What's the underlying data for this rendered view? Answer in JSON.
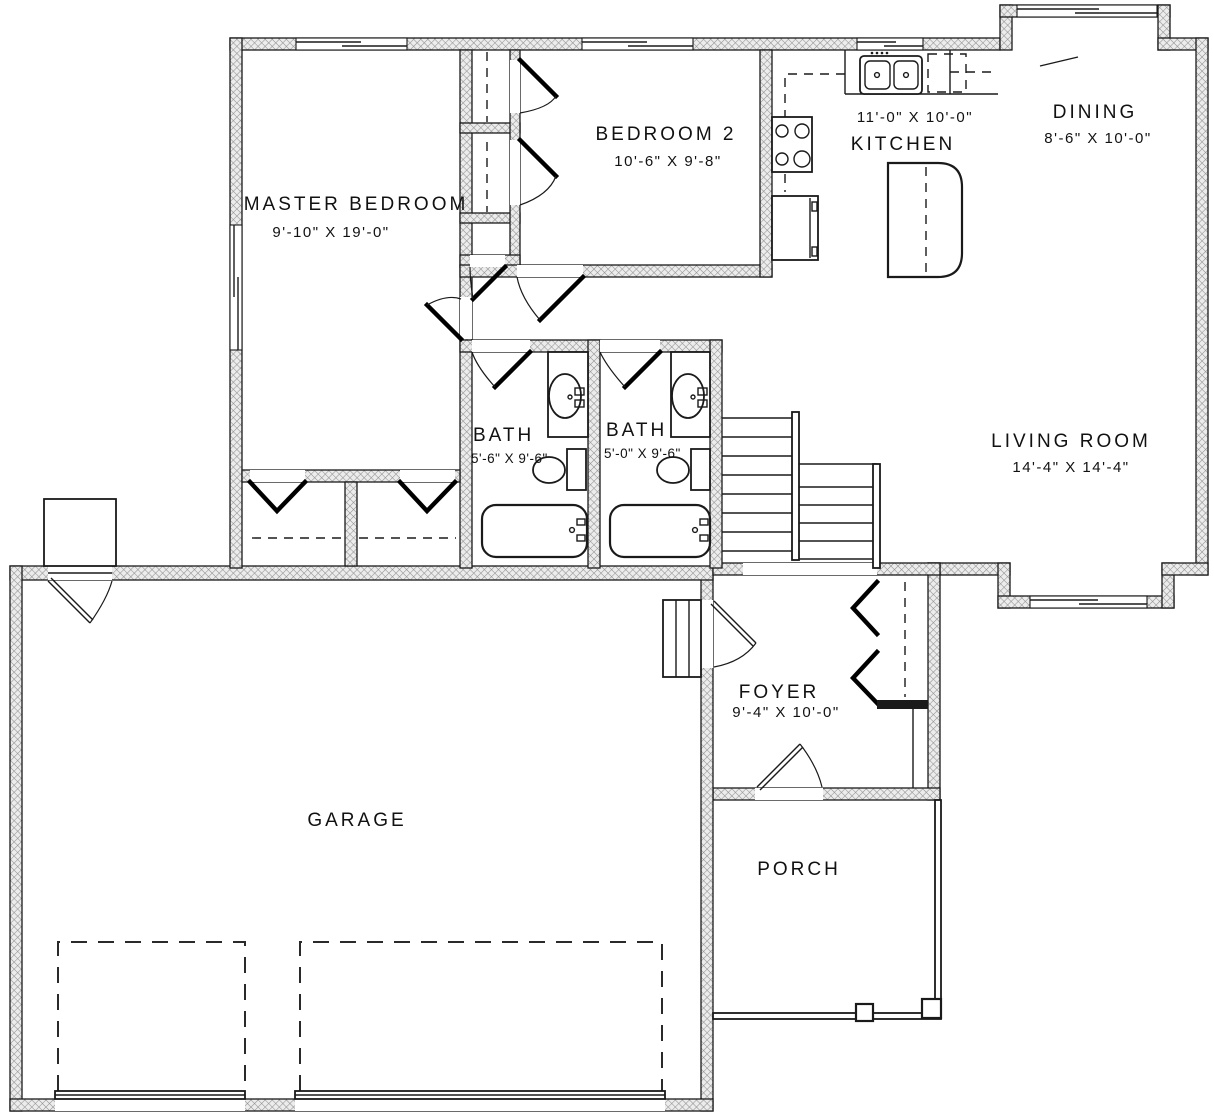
{
  "plan": {
    "rooms": {
      "master_bedroom": {
        "name": "MASTER BEDROOM",
        "dims": "9'-10\" X 19'-0\""
      },
      "bedroom_2": {
        "name": "BEDROOM 2",
        "dims": "10'-6\" X 9'-8\""
      },
      "kitchen": {
        "name": "KITCHEN",
        "dims": "11'-0\" X 10'-0\""
      },
      "dining": {
        "name": "DINING",
        "dims": "8'-6\" X 10'-0\""
      },
      "living_room": {
        "name": "LIVING ROOM",
        "dims": "14'-4\" X 14'-4\""
      },
      "bath_1": {
        "name": "BATH",
        "dims": "5'-6\" X 9'-6\""
      },
      "bath_2": {
        "name": "BATH",
        "dims": "5'-0\" X 9'-6\""
      },
      "foyer": {
        "name": "FOYER",
        "dims": "9'-4\" X 10'-0\""
      },
      "garage": {
        "name": "GARAGE"
      },
      "porch": {
        "name": "PORCH"
      }
    },
    "colors": {
      "line": "#1a1a1a",
      "wall_hatch": "#909090",
      "background": "#ffffff"
    }
  }
}
